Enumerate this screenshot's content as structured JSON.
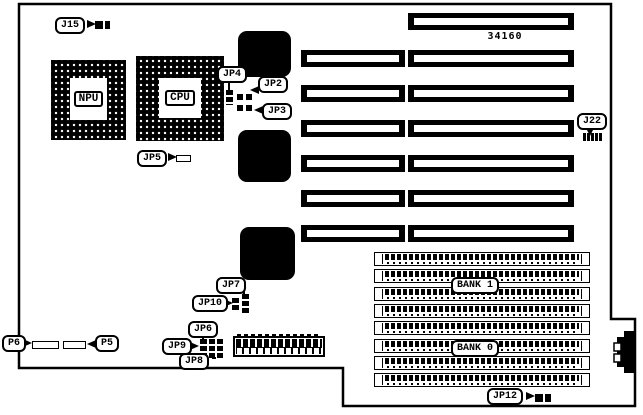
{
  "part_number": "34160",
  "labels": {
    "j15": "J15",
    "npu": "NPU",
    "cpu": "CPU",
    "jp2": "JP2",
    "jp3": "JP3",
    "jp4": "JP4",
    "jp5": "JP5",
    "jp6": "JP6",
    "jp7": "JP7",
    "jp8": "JP8",
    "jp9": "JP9",
    "jp10": "JP10",
    "jp12": "JP12",
    "j22": "J22",
    "p5": "P5",
    "p6": "P6"
  },
  "memory": {
    "bank1": "BANK 1",
    "bank0": "BANK 0"
  },
  "colors": {
    "ink": "#000000",
    "paper": "#ffffff"
  }
}
